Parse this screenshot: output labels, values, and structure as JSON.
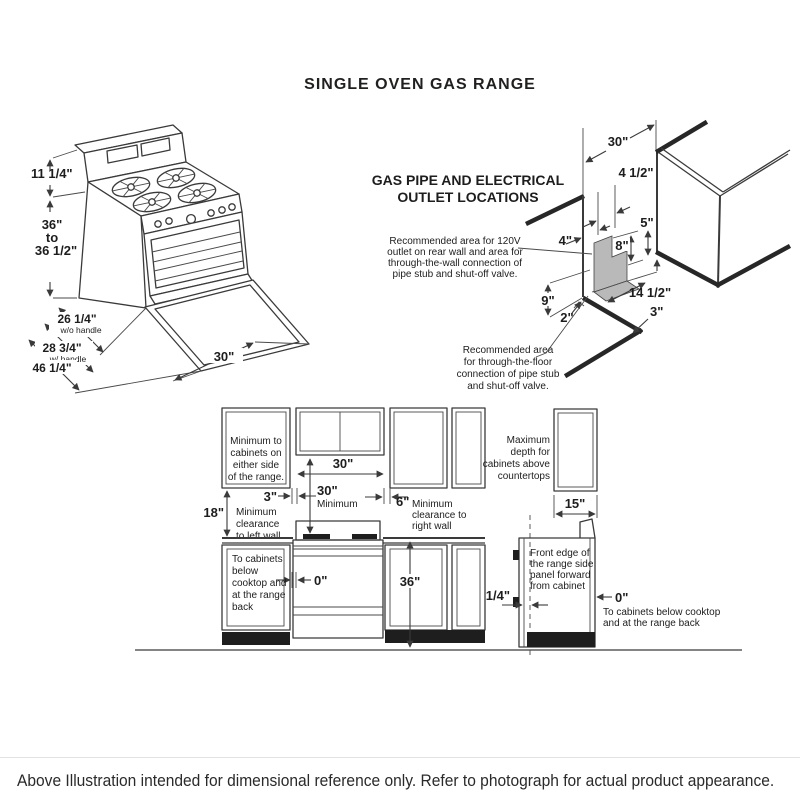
{
  "page": {
    "title": "SINGLE OVEN GAS RANGE",
    "disclaimer": "Above Illustration intended for dimensional reference only. Refer to photograph for actual product appearance."
  },
  "range_drawing": {
    "backsplash_height": "11 1/4\"",
    "height": [
      "36\"",
      "to",
      "36 1/2\""
    ],
    "depth_wo_handle": "26 1/4\"",
    "depth_wo_handle_note": "w/o handle",
    "depth_w_handle": "28 3/4\"",
    "depth_w_handle_note": "w/ handle",
    "depth_door_open": "46 1/4\"",
    "width": "30\""
  },
  "gas_diagram": {
    "title": [
      "GAS PIPE AND ELECTRICAL",
      "OUTLET LOCATIONS"
    ],
    "wall_note": [
      "Recommended area for 120V",
      "outlet on rear wall and area for",
      "through-the-wall connection of",
      "pipe stub and shut-off valve."
    ],
    "floor_note": [
      "Recommended area",
      "for through-the-floor",
      "connection of pipe stub",
      "and shut-off valve."
    ],
    "dim_width": "30\"",
    "dim_outlet_width": "4 1/2\"",
    "dim_five": "5\"",
    "dim_four": "4\"",
    "dim_eight": "8\"",
    "dim_nine": "9\"",
    "dim_two": "2\"",
    "dim_fourteen_half": "14 1/2\"",
    "dim_three": "3\""
  },
  "cabinet_diagram": {
    "side_cab_note": [
      "Minimum to",
      "cabinets on",
      "either side",
      "of the range."
    ],
    "opening_width": "30\"",
    "min_vert": "30\"",
    "min_vert_label": "Minimum",
    "left_gap": "3\"",
    "left_wall_note": [
      "Minimum",
      "clearance",
      "to left wall"
    ],
    "side_clearance": "18\"",
    "right_gap": "6\"",
    "right_wall_note": [
      "Minimum",
      "clearance to",
      "right wall"
    ],
    "below_note": [
      "To cabinets",
      "below",
      "cooktop and",
      "at the range",
      "back"
    ],
    "zero_front": "0\"",
    "counter_height": "36\"",
    "max_depth_note": [
      "Maximum",
      "depth for",
      "cabinets above",
      "countertops"
    ],
    "cab_depth": "15\"",
    "front_edge_note": [
      "Front edge of",
      "the range side",
      "panel forward",
      "from cabinet"
    ],
    "quarter": "1/4\"",
    "zero_back": "0\"",
    "back_note": [
      "To cabinets below cooktop",
      "and at the range back"
    ]
  }
}
